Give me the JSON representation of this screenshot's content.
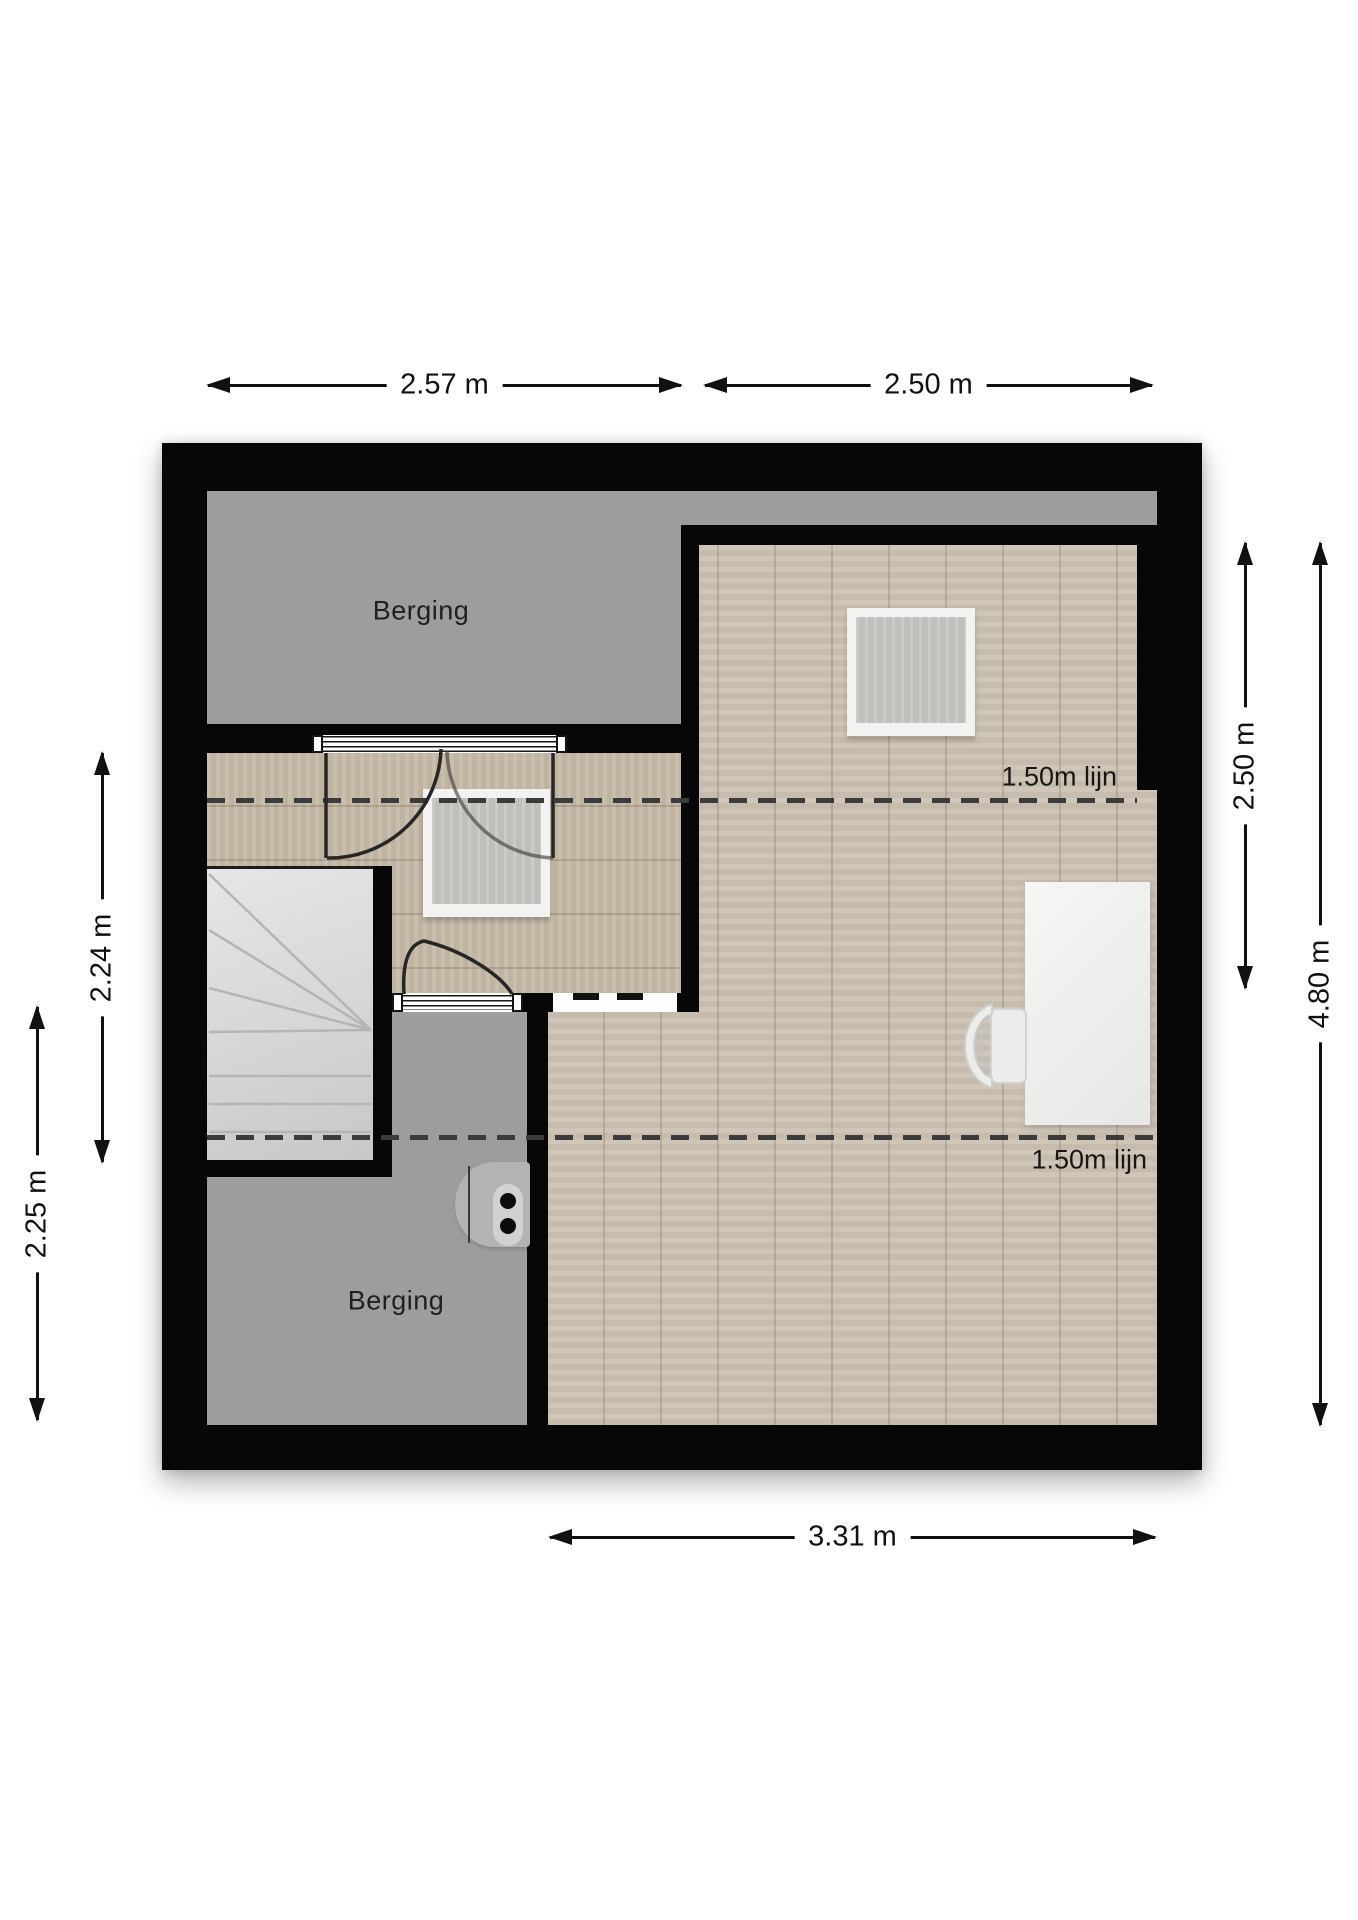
{
  "plan": {
    "type": "attic floor plan",
    "rooms": {
      "berging_top": "Berging",
      "berging_bottom": "Berging"
    },
    "annotations": {
      "knee_line_1": "1.50m lijn",
      "knee_line_2": "1.50m lijn"
    },
    "dimensions": {
      "top_left": "2.57 m",
      "top_right": "2.50 m",
      "right_upper": "2.50 m",
      "right_total": "4.80 m",
      "left_upper": "2.24 m",
      "left_lower": "2.25 m",
      "bottom": "3.31 m"
    },
    "colors": {
      "wall": "#070707",
      "storage_gray": "#9e9d9b",
      "hall_wood": "#c6baa7",
      "main_wood": "#ccc2b3",
      "stairs_gray": "#d8d8d6",
      "dash_line": "#3b3b3b",
      "background": "#ffffff"
    }
  }
}
